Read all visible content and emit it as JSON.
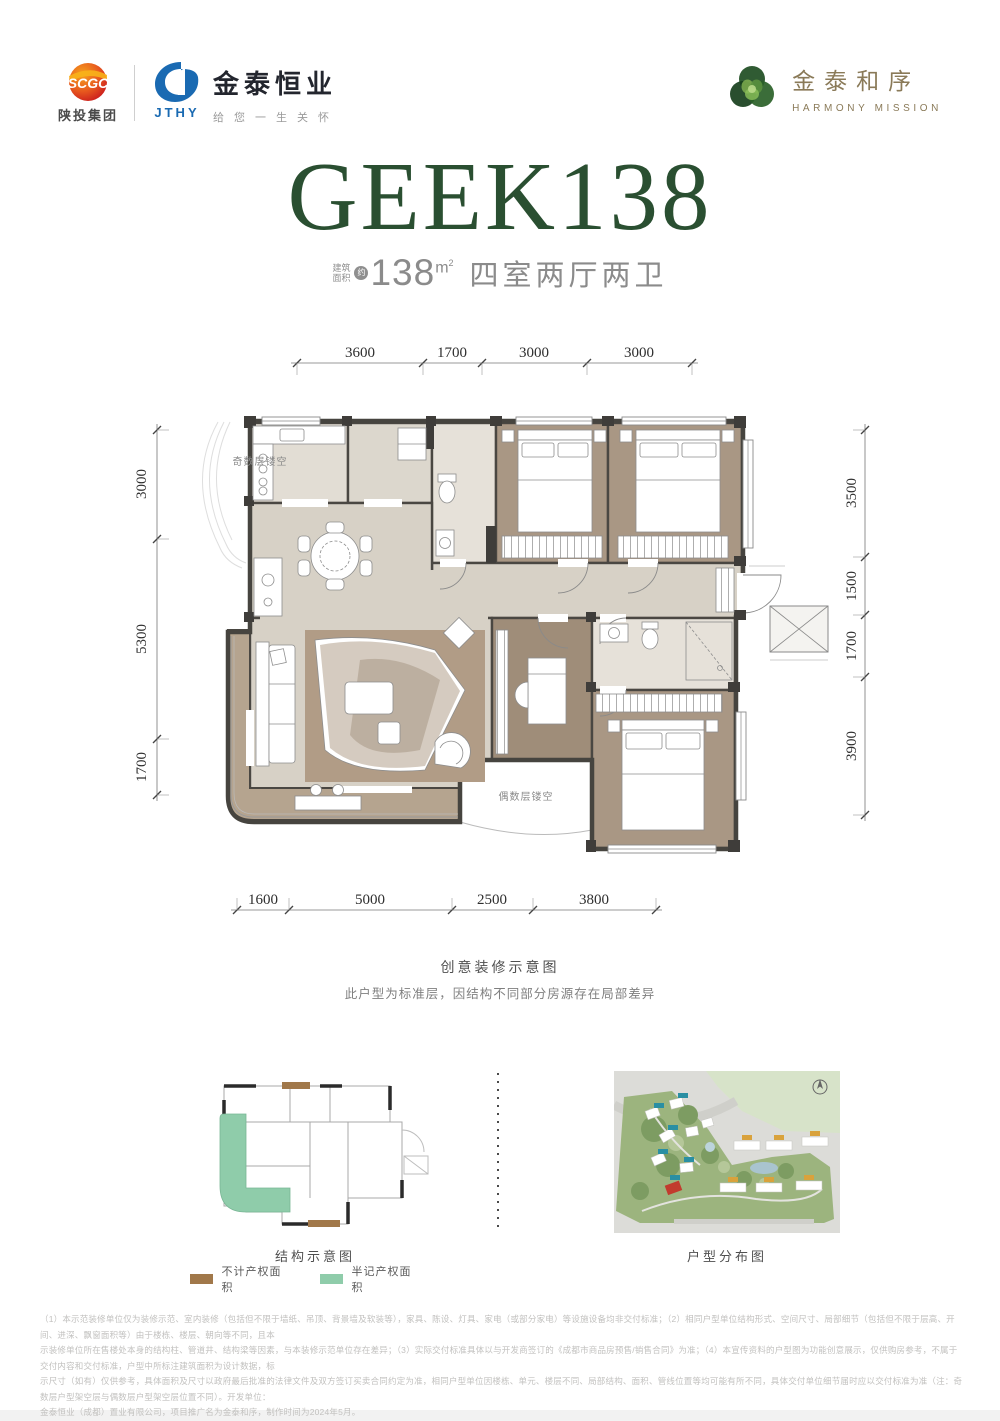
{
  "header": {
    "scgc": {
      "logo": "SCGC",
      "name": "陕投集团"
    },
    "jthy": {
      "logo": "JTHY",
      "name": "金泰恒业",
      "tagline": "给您一生关怀"
    },
    "brand": {
      "name": "金泰和序",
      "name_en": "HARMONY MISSION"
    }
  },
  "hero": {
    "title": "GEEK138",
    "area_label_1": "建筑",
    "area_label_2": "面积",
    "approx": "约",
    "area_value": "138",
    "area_unit_m": "m",
    "area_unit_sup": "2",
    "rooms": "四室两厅两卫"
  },
  "floorplan": {
    "dims_top": [
      "3600",
      "1700",
      "3000",
      "3000"
    ],
    "dims_bottom": [
      "1600",
      "5000",
      "2500",
      "3800"
    ],
    "dims_left": [
      "3000",
      "5300",
      "1700"
    ],
    "dims_right": [
      "3500",
      "1500",
      "1700",
      "3900"
    ],
    "void_odd": "奇数层镂空",
    "void_even": "偶数层镂空",
    "caption": "创意装修示意图",
    "note": "此户型为标准层，因结构不同部分房源存在局部差异"
  },
  "structure": {
    "caption": "结构示意图",
    "legend": [
      {
        "swatch": "#a1784a",
        "label": "不计产权面积"
      },
      {
        "swatch": "#8fccaa",
        "label": "半记产权面积"
      }
    ]
  },
  "siteplan": {
    "caption": "户型分布图"
  },
  "disclaimer": {
    "line1": "（1）本示范装修单位仅为装修示范、室内装修（包括但不限于墙纸、吊顶、背景墙及软装等），家具、陈设、灯具、家电（或部分家电）等设施设备均非交付标准；（2）相同户型单位结构形式、空间尺寸、局部细节（包括但不限于层高、开间、进深、飘窗面积等）由于楼栋、楼层、朝向等不同，且本",
    "line2": "示装修单位所在售楼处本身的结构柱、管道井、结构梁等因素，与本装修示范单位存在差异；（3）实际交付标准具体以与开发商签订的《成都市商品房预售/销售合同》为准；（4）本宣传资料的户型图为功能创意展示，仅供购房参考，不属于交付内容和交付标准，户型中所标注建筑面积为设计数据，标",
    "line3": "示尺寸（如有）仅供参考，具体面积及尺寸以政府最后批准的法律文件及双方签订买卖合同约定为准，相同户型单位因楼栋、单元、楼层不同、局部结构、面积、管线位置等均可能有所不同，具体交付单位细节届时应以交付标准为准（注：奇数层户型架空层与偶数层户型架空层位置不同）。开发单位：",
    "line4": "金泰恒业（成都）置业有限公司，项目推广名为金泰和序，制作时间为2024年5月。"
  },
  "colors": {
    "brand_green": "#2a4f31",
    "logo_gold": "#8a7a58",
    "jthy_blue": "#1a6ab2",
    "scgc_red": "#d6342a",
    "legend_brown": "#a1784a",
    "legend_green": "#8fccaa"
  }
}
